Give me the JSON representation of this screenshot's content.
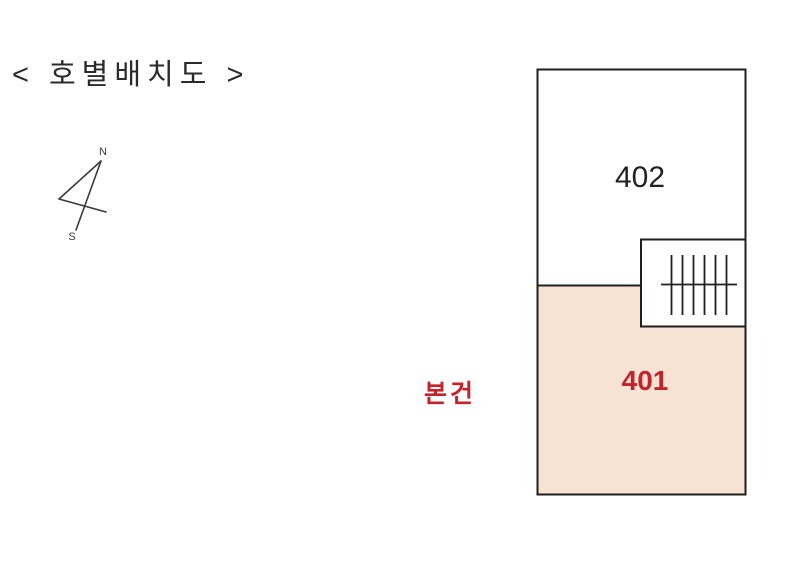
{
  "title": "< 호별배치도 >",
  "compass": {
    "north_label": "N",
    "south_label": "S"
  },
  "floor_plan": {
    "units": [
      {
        "number": "402",
        "highlighted": false
      },
      {
        "number": "401",
        "highlighted": true
      }
    ],
    "subject_marker": "본건",
    "stair_icon": "staircase-hatch"
  },
  "colors": {
    "plan-line": "#1f1f1f",
    "compass-line": "#3a3a3a",
    "unit-fill": "#ffffff",
    "highlight-fill": "#f7e3d3",
    "highlight-red": "#c3242c",
    "unit-number-color": "#222222",
    "title-color": "#2b2b2b"
  }
}
